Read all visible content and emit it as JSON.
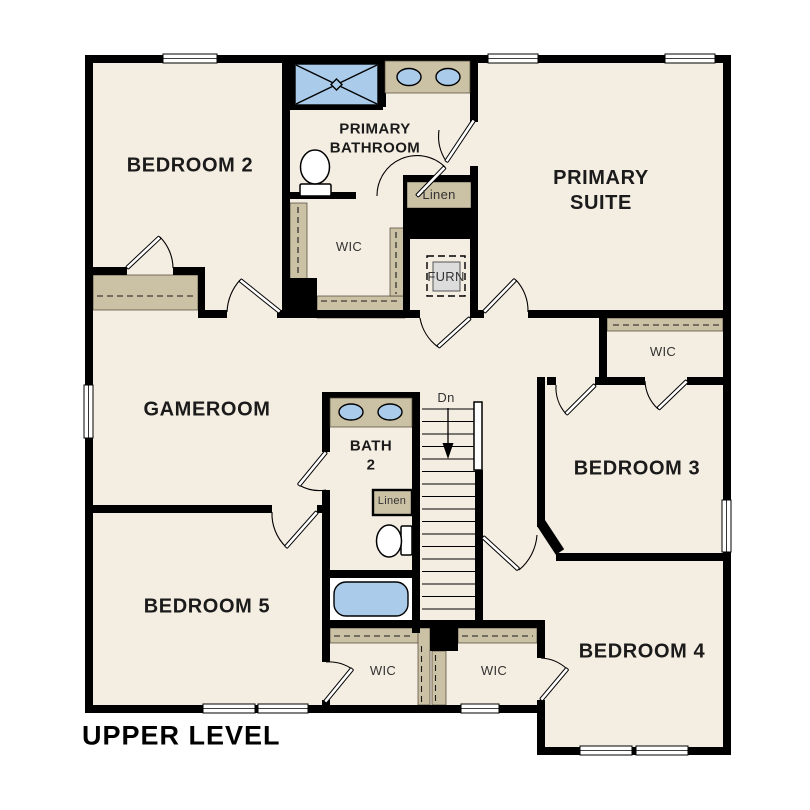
{
  "title": "UPPER LEVEL",
  "colors": {
    "background": "#ffffff",
    "floor": "#f4ede2",
    "wall": "#000000",
    "casework_tan": "#cbc1a5",
    "fixture_blue": "#aacbea",
    "furnace_gray": "#dcdcdc",
    "room_label": "#1b1b1b",
    "small_label": "#333333"
  },
  "rooms": [
    {
      "name": "bedroom-2",
      "label": "BEDROOM 2"
    },
    {
      "name": "primary-bathroom",
      "label": "PRIMARY\nBATHROOM"
    },
    {
      "name": "primary-suite",
      "label": "PRIMARY\nSUITE"
    },
    {
      "name": "gameroom",
      "label": "GAMEROOM"
    },
    {
      "name": "bath-2",
      "label": "BATH\n2"
    },
    {
      "name": "bedroom-3",
      "label": "BEDROOM 3"
    },
    {
      "name": "bedroom-5",
      "label": "BEDROOM 5"
    },
    {
      "name": "bedroom-4",
      "label": "BEDROOM 4"
    }
  ],
  "closets": [
    {
      "name": "linen-primary",
      "label": "Linen"
    },
    {
      "name": "wic-primary",
      "label": "WIC"
    },
    {
      "name": "furnace",
      "label": "FURN"
    },
    {
      "name": "wic-bedroom-3",
      "label": "WIC"
    },
    {
      "name": "linen-bath-2",
      "label": "Linen"
    },
    {
      "name": "wic-bedroom-5",
      "label": "WIC"
    },
    {
      "name": "wic-bedroom-4",
      "label": "WIC"
    }
  ],
  "stairs": {
    "direction_label": "Dn"
  }
}
